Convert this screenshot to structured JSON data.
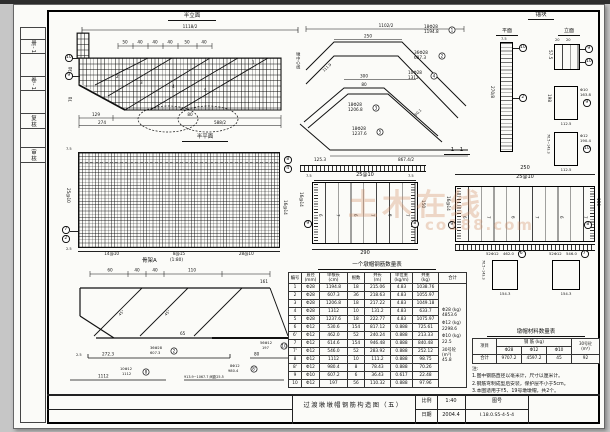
{
  "sheet": {
    "watermark1": "土木在线",
    "watermark2": "co188.com"
  },
  "margin": {
    "labels": [
      "册-1",
      "卷-1",
      "复核",
      "审核"
    ]
  },
  "elev": {
    "title": "半立面",
    "dim_total": "1118/2",
    "top_dims": [
      "50",
      "40",
      "40",
      "40",
      "50",
      "40"
    ],
    "dim_129": "129",
    "dim_80": "80",
    "dim_274": "274",
    "dim_588": "588/2",
    "dim_30": "30",
    "dim_70": "70",
    "centerline": "墩中心线",
    "mark_10": "10",
    "mark_9": "9",
    "bar_marks": [
      "2",
      "3",
      "4",
      "5",
      "1"
    ]
  },
  "bent": {
    "dim_1102": "1102/2",
    "dim_250": "250",
    "dim_300": "300",
    "dim_80": "80",
    "dim_867": "867.4/2",
    "dim_125": "125.3",
    "dim_111": "111.9",
    "dim_50": "50.1",
    "b1": {
      "count": "18Φ28",
      "len": "1194.8",
      "mark": "1"
    },
    "b2": {
      "count": "36Φ28",
      "len": "607.3",
      "mark": "2"
    },
    "b3": {
      "count": "18Φ28",
      "len": "1206.8",
      "mark": "3"
    },
    "b4": {
      "count": "10Φ28",
      "len": "1312",
      "mark": "4"
    },
    "b5": {
      "count": "18Φ28",
      "len": "1237.6",
      "mark": "5"
    }
  },
  "anchor": {
    "title": "锚块",
    "plan": "平面",
    "elevation": "立面",
    "dim_270": "270/8",
    "dim_75": "7.5",
    "mark_top": "10",
    "mark_mid": "2",
    "ev_dim_20a": "20",
    "ev_dim_20b": "20",
    "ev_dim_575": "57.5",
    "ev_mark1": "9",
    "ev_mark2": "10",
    "rectA": {
      "dim_left": "198",
      "dim_bottom": "112.5",
      "bar": "Φ10",
      "len": "163.8",
      "mark": "9"
    },
    "rectB": {
      "dim_left": "76.5~143.3",
      "dim_bottom": "112.5",
      "bar": "Φ12",
      "len": "190.4",
      "mark": "10"
    }
  },
  "plan": {
    "title": "半平面",
    "dim_left": "25@10",
    "dim_right": "16@14",
    "bottom_dims": [
      "14@10",
      "8@15",
      "28@10"
    ],
    "dim_c1": "7.5",
    "dim_c2": "2.5",
    "marks_right": [
      "8",
      "4"
    ],
    "marks_left": [
      "7",
      "2"
    ]
  },
  "sections": {
    "label_11": "1—1",
    "s1": {
      "dim_top": "25@10",
      "dim_7a": "7.5",
      "dim_7b": "7.5",
      "dim_bottom": "290",
      "dim_left": "16@14",
      "dim_right": "150",
      "mark_left": "9",
      "mark_right": "8",
      "bars": [
        "6",
        "7",
        "6",
        "7",
        "6",
        "7"
      ]
    },
    "s2": {
      "dim_total": "250",
      "dim_top": "25@10",
      "dim_left": "16@14",
      "dim_right": "150",
      "mark_left": "9",
      "mark_right": "8",
      "bars": [
        "6",
        "7",
        "6",
        "7",
        "6",
        "7"
      ],
      "r1": {
        "count": "52Φ12",
        "len": "462.0",
        "mark": "6'",
        "dim_bottom": "154.3",
        "dim_left": "76.5~143.3"
      },
      "r2": {
        "count": "52Φ12",
        "len": "546.0",
        "mark": "7'",
        "dim_bottom": "154.3"
      }
    }
  },
  "skeleton": {
    "title": "骨架A",
    "scale": "(1:80)",
    "top_dims": [
      "60",
      "40",
      "40",
      "110"
    ],
    "dim_161": "161",
    "dim_65": "65",
    "angle1": "45°",
    "angle2": "45°",
    "d1": {
      "dim": "272.3",
      "tiny": "2.5",
      "count": "36Φ28",
      "len": "607.3",
      "mark": "2"
    },
    "d2": {
      "dim": "80",
      "count": "56Φ12",
      "len": "197",
      "mark": "10"
    },
    "d3": {
      "dim": "1112",
      "count": "10Φ12",
      "len": "1112",
      "mark": "8"
    },
    "d4": {
      "dim": "913.9~1067.7 间距25.5",
      "count": "8Φ12",
      "len": "980.4",
      "mark": "8'"
    }
  },
  "main_table": {
    "title": "一个墩帽钢筋数量表",
    "headers": [
      "编号",
      "直径\n(mm)",
      "单根长\n(cm)",
      "根数",
      "共长\n(m)",
      "单位重\n(kg/m)",
      "共重\n(kg)",
      "合计"
    ],
    "rows": [
      [
        "1",
        "Φ28",
        "1194.8",
        "18",
        "215.06",
        "4.83",
        "1038.76"
      ],
      [
        "2",
        "Φ28",
        "607.3",
        "36",
        "218.63",
        "4.83",
        "1055.97"
      ],
      [
        "3",
        "Φ28",
        "1206.8",
        "18",
        "217.22",
        "4.83",
        "1049.18"
      ],
      [
        "4",
        "Φ28",
        "1312",
        "10",
        "131.2",
        "4.83",
        "633.7"
      ],
      [
        "5",
        "Φ28",
        "1237.6",
        "18",
        "222.77",
        "4.83",
        "1075.97"
      ],
      [
        "6",
        "Φ12",
        "530.6",
        "154",
        "817.12",
        "0.888",
        "725.61"
      ],
      [
        "6'",
        "Φ12",
        "462.0",
        "52",
        "240.24",
        "0.888",
        "213.33"
      ],
      [
        "7",
        "Φ12",
        "614.6",
        "154",
        "946.48",
        "0.888",
        "840.48"
      ],
      [
        "7'",
        "Φ12",
        "546.0",
        "52",
        "283.92",
        "0.888",
        "252.12"
      ],
      [
        "8",
        "Φ12",
        "1112",
        "10",
        "111.2",
        "0.888",
        "98.75"
      ],
      [
        "8'",
        "Φ12",
        "980.4",
        "8",
        "78.43",
        "0.888",
        "70.26"
      ],
      [
        "9",
        "Φ10",
        "607.2",
        "6",
        "36.43",
        "0.617",
        "22.48"
      ],
      [
        "10",
        "Φ12",
        "197",
        "56",
        "110.32",
        "0.888",
        "97.96"
      ]
    ],
    "summary": [
      {
        "label": "Φ28 (kg)",
        "value": "4853.6"
      },
      {
        "label": "Φ12 (kg)",
        "value": "2298.6"
      },
      {
        "label": "Φ10 (kg)",
        "value": "22.5"
      },
      {
        "label": "30号砼 (m³)",
        "value": "45.8"
      }
    ]
  },
  "material_table": {
    "title": "墩帽材料数量表",
    "col_item": "项目",
    "col_steel": "钢 筋 (kg)",
    "col_conc": "30号砼\n(m³)",
    "sub": [
      "Φ28",
      "Φ12",
      "Φ10"
    ],
    "total_label": "合计",
    "values": [
      "9707.2",
      "4597.2",
      "45",
      "92"
    ]
  },
  "notes": {
    "head": "注:",
    "items": [
      "1.图中钢筋直径以毫米计，尺寸以厘米计。",
      "2.钢筋弯制成型后安装，保护层不小于5cm。",
      "3.本图适用于Y5、19号墩墩帽，共2个。"
    ]
  },
  "titleblock": {
    "title": "过渡墩墩帽钢筋构造图（五）",
    "scale_label": "比例",
    "scale": "1:40",
    "date_label": "日期",
    "date": "2004.4",
    "no_label": "图号",
    "no": "I.18.0.S5-4-5-4"
  }
}
